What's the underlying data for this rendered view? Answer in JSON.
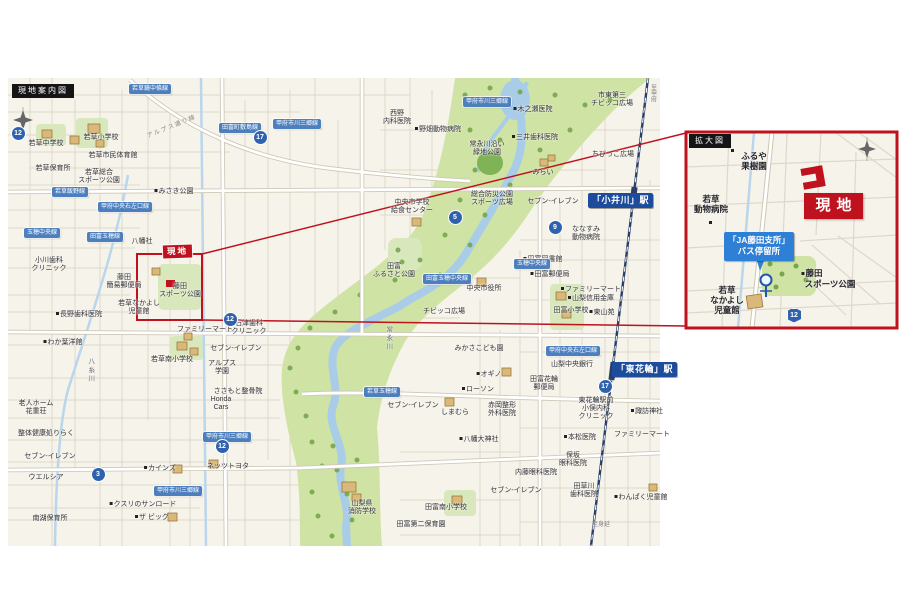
{
  "title_labels": {
    "main": "現地案内図",
    "inset": "拡大図"
  },
  "site": {
    "main_label": "現地",
    "inset_label": "現地"
  },
  "stations": {
    "koigawa": "「小井川」駅",
    "higashihanawa": "「東花輪」駅"
  },
  "bus_stop": {
    "line1": "「JA藤田支所」",
    "line2": "バス停留所"
  },
  "colors": {
    "accent_red": "#bf111e",
    "station_blue": "#1d4c9d",
    "plate_blue": "#4d7fbe",
    "bus_blue": "#2e7fd6",
    "map_cream": "#f6f3ea",
    "park_green": "#cfe3a4",
    "water_blue": "#a9cce8",
    "rail_navy": "#2a3f68"
  },
  "map_labels": [
    {
      "lines": [
        "若草中学校"
      ],
      "x": 46,
      "y": 140
    },
    {
      "lines": [
        "若草小学校"
      ],
      "x": 101,
      "y": 134
    },
    {
      "lines": [
        "若草市民体育館"
      ],
      "x": 113,
      "y": 152
    },
    {
      "lines": [
        "若草保育所"
      ],
      "x": 53,
      "y": 165
    },
    {
      "lines": [
        "若草総合",
        "スポーツ公園"
      ],
      "x": 99,
      "y": 169
    },
    {
      "lines": [
        "みさき公園"
      ],
      "x": 174,
      "y": 188,
      "d": 1
    },
    {
      "lines": [
        "八幡社"
      ],
      "x": 142,
      "y": 238
    },
    {
      "lines": [
        "小川歯科",
        "クリニック"
      ],
      "x": 49,
      "y": 257
    },
    {
      "lines": [
        "藤田",
        "簡易郵便局"
      ],
      "x": 124,
      "y": 274
    },
    {
      "lines": [
        "藤田",
        "スポーツ公園"
      ],
      "x": 180,
      "y": 283
    },
    {
      "lines": [
        "若草なかよし",
        "児童館"
      ],
      "x": 139,
      "y": 300
    },
    {
      "lines": [
        "長野歯科医院"
      ],
      "x": 79,
      "y": 311,
      "d": 1
    },
    {
      "lines": [
        "わか葉洋館"
      ],
      "x": 63,
      "y": 339,
      "d": 1
    },
    {
      "lines": [
        "老人ホーム",
        "花重荘"
      ],
      "x": 36,
      "y": 400
    },
    {
      "lines": [
        "整体健康処りらく"
      ],
      "x": 46,
      "y": 430
    },
    {
      "lines": [
        "セブン-イレブン"
      ],
      "x": 50,
      "y": 453
    },
    {
      "lines": [
        "ウエルシア"
      ],
      "x": 46,
      "y": 474
    },
    {
      "lines": [
        "南湖保育所"
      ],
      "x": 50,
      "y": 515
    },
    {
      "lines": [
        "カインズ"
      ],
      "x": 160,
      "y": 465,
      "d": 1
    },
    {
      "lines": [
        "ネッツトヨタ"
      ],
      "x": 228,
      "y": 463
    },
    {
      "lines": [
        "クスリのサンロード"
      ],
      "x": 143,
      "y": 501,
      "d": 1
    },
    {
      "lines": [
        "ザ ビッグ"
      ],
      "x": 152,
      "y": 514,
      "d": 1
    },
    {
      "lines": [
        "ファミリーマート"
      ],
      "x": 205,
      "y": 326
    },
    {
      "lines": [
        "石津歯科",
        "クリニック"
      ],
      "x": 249,
      "y": 320
    },
    {
      "lines": [
        "セブン-イレブン"
      ],
      "x": 236,
      "y": 345
    },
    {
      "lines": [
        "若草南小学校"
      ],
      "x": 172,
      "y": 356
    },
    {
      "lines": [
        "アルプス",
        "学園"
      ],
      "x": 222,
      "y": 360
    },
    {
      "lines": [
        "ささもと整骨院"
      ],
      "x": 238,
      "y": 388
    },
    {
      "lines": [
        "Honda",
        "Cars"
      ],
      "x": 221,
      "y": 396
    },
    {
      "lines": [
        "田富",
        "ふるさと公園"
      ],
      "x": 394,
      "y": 263
    },
    {
      "lines": [
        "西野",
        "内科医院"
      ],
      "x": 397,
      "y": 110
    },
    {
      "lines": [
        "野畑動物病院"
      ],
      "x": 438,
      "y": 126,
      "d": 1
    },
    {
      "lines": [
        "常永川沿い",
        "緑地公園"
      ],
      "x": 487,
      "y": 141
    },
    {
      "lines": [
        "木之瀬医院"
      ],
      "x": 533,
      "y": 106,
      "d": 1
    },
    {
      "lines": [
        "三井歯科医院"
      ],
      "x": 535,
      "y": 134,
      "d": 1
    },
    {
      "lines": [
        "市東第三",
        "チビッコ広場"
      ],
      "x": 612,
      "y": 92
    },
    {
      "lines": [
        "ちびっこ広場"
      ],
      "x": 613,
      "y": 151
    },
    {
      "lines": [
        "みらい"
      ],
      "x": 543,
      "y": 169
    },
    {
      "lines": [
        "セブン-イレブン"
      ],
      "x": 553,
      "y": 198
    },
    {
      "lines": [
        "中央市学校",
        "給食センター"
      ],
      "x": 412,
      "y": 199
    },
    {
      "lines": [
        "総合防災公園",
        "スポーツ広場"
      ],
      "x": 492,
      "y": 191
    },
    {
      "lines": [
        "ななすみ",
        "動物病院"
      ],
      "x": 586,
      "y": 226
    },
    {
      "lines": [
        "田富図書館"
      ],
      "x": 543,
      "y": 256,
      "d": 1
    },
    {
      "lines": [
        "田富郵便局"
      ],
      "x": 550,
      "y": 271,
      "d": 1
    },
    {
      "lines": [
        "中央市役所"
      ],
      "x": 484,
      "y": 285
    },
    {
      "lines": [
        "チビッコ広場"
      ],
      "x": 444,
      "y": 308
    },
    {
      "lines": [
        "田富小学校"
      ],
      "x": 571,
      "y": 307
    },
    {
      "lines": [
        "東山苑"
      ],
      "x": 602,
      "y": 309,
      "d": 1
    },
    {
      "lines": [
        "みかさこども園"
      ],
      "x": 479,
      "y": 345
    },
    {
      "lines": [
        "オギノ"
      ],
      "x": 489,
      "y": 371,
      "d": 1
    },
    {
      "lines": [
        "ローソン"
      ],
      "x": 478,
      "y": 386,
      "d": 1
    },
    {
      "lines": [
        "セブン-イレブン"
      ],
      "x": 413,
      "y": 402
    },
    {
      "lines": [
        "しまむら"
      ],
      "x": 455,
      "y": 409
    },
    {
      "lines": [
        "赤岡整形",
        "外科医院"
      ],
      "x": 502,
      "y": 402
    },
    {
      "lines": [
        "八幡大神社"
      ],
      "x": 479,
      "y": 436,
      "d": 1
    },
    {
      "lines": [
        "内藤眼科医院"
      ],
      "x": 536,
      "y": 469
    },
    {
      "lines": [
        "セブン-イレブン"
      ],
      "x": 516,
      "y": 487
    },
    {
      "lines": [
        "山梨県",
        "消防学校"
      ],
      "x": 362,
      "y": 500
    },
    {
      "lines": [
        "田富南小学校"
      ],
      "x": 446,
      "y": 504
    },
    {
      "lines": [
        "田富第二保育園"
      ],
      "x": 421,
      "y": 521
    },
    {
      "lines": [
        "ファミリーマート"
      ],
      "x": 591,
      "y": 286,
      "d": 1
    },
    {
      "lines": [
        "山梨信用金庫"
      ],
      "x": 591,
      "y": 295,
      "d": 1
    },
    {
      "lines": [
        "山梨中央銀行"
      ],
      "x": 572,
      "y": 361
    },
    {
      "lines": [
        "田富花輪",
        "郵便局"
      ],
      "x": 544,
      "y": 376
    },
    {
      "lines": [
        "東花輪駅前",
        "小俣内科",
        "クリニック"
      ],
      "x": 596,
      "y": 397
    },
    {
      "lines": [
        "諏訪神社"
      ],
      "x": 647,
      "y": 408,
      "d": 1
    },
    {
      "lines": [
        "ファミリーマート"
      ],
      "x": 642,
      "y": 431
    },
    {
      "lines": [
        "本松医院"
      ],
      "x": 580,
      "y": 434,
      "d": 1
    },
    {
      "lines": [
        "保坂",
        "眼科医院"
      ],
      "x": 573,
      "y": 452
    },
    {
      "lines": [
        "田草川",
        "歯科医院"
      ],
      "x": 584,
      "y": 483
    },
    {
      "lines": [
        "わんぱく児童館"
      ],
      "x": 641,
      "y": 494,
      "d": 1
    },
    {
      "lines": [
        "常永川"
      ],
      "x": 388,
      "y": 326,
      "c": "v"
    },
    {
      "lines": [
        "八糸川"
      ],
      "x": 90,
      "y": 358,
      "c": "v"
    },
    {
      "lines": [
        "至甲府"
      ],
      "x": 652,
      "y": 84,
      "c": "vg"
    },
    {
      "lines": [
        "至身延"
      ],
      "x": 601,
      "y": 522,
      "c": "g"
    },
    {
      "lines": [
        "アルプス通り線"
      ],
      "x": 172,
      "y": 124,
      "c": "r",
      "rot": -22
    },
    {
      "lines": [
        "ふるや",
        "果樹園"
      ],
      "x": 754,
      "y": 151,
      "c": "i"
    },
    {
      "lines": [
        "若草",
        "動物病院"
      ],
      "x": 711,
      "y": 194,
      "c": "i"
    },
    {
      "lines": [
        "藤田"
      ],
      "x": 812,
      "y": 268,
      "c": "i",
      "d": 1
    },
    {
      "lines": [
        "スポーツ公園"
      ],
      "x": 830,
      "y": 279,
      "c": "i"
    },
    {
      "lines": [
        "若草",
        "なかよし",
        "児童館"
      ],
      "x": 727,
      "y": 285,
      "c": "i"
    }
  ],
  "road_plates": [
    {
      "x": 150,
      "y": 84,
      "t": "若草鏡中條線"
    },
    {
      "x": 240,
      "y": 123,
      "t": "田富町敷島線"
    },
    {
      "x": 297,
      "y": 119,
      "t": "甲府市川三郷線"
    },
    {
      "x": 487,
      "y": 97,
      "t": "甲府市川三郷線"
    },
    {
      "x": 70,
      "y": 187,
      "t": "若草飯野線"
    },
    {
      "x": 125,
      "y": 202,
      "t": "甲府中央右左口線"
    },
    {
      "x": 42,
      "y": 228,
      "t": "玉穂中央線"
    },
    {
      "x": 105,
      "y": 232,
      "t": "田富玉穂線"
    },
    {
      "x": 447,
      "y": 274,
      "t": "田富玉穂中央線"
    },
    {
      "x": 382,
      "y": 387,
      "t": "若草玉穂線"
    },
    {
      "x": 573,
      "y": 346,
      "t": "甲府中央右左口線"
    },
    {
      "x": 227,
      "y": 432,
      "t": "甲府市川三郷線"
    },
    {
      "x": 178,
      "y": 486,
      "t": "甲府市川三郷線"
    },
    {
      "x": 532,
      "y": 259,
      "t": "玉穂中央線"
    }
  ],
  "route_badges": [
    {
      "x": 18,
      "y": 133,
      "n": "12"
    },
    {
      "x": 260,
      "y": 137,
      "n": "17"
    },
    {
      "x": 455,
      "y": 217,
      "n": "5"
    },
    {
      "x": 230,
      "y": 319,
      "n": "12"
    },
    {
      "x": 555,
      "y": 227,
      "n": "9"
    },
    {
      "x": 605,
      "y": 386,
      "n": "17"
    },
    {
      "x": 98,
      "y": 474,
      "n": "3"
    },
    {
      "x": 222,
      "y": 446,
      "n": "12"
    },
    {
      "x": 793,
      "y": 314,
      "n": "12",
      "hex": 1
    }
  ]
}
